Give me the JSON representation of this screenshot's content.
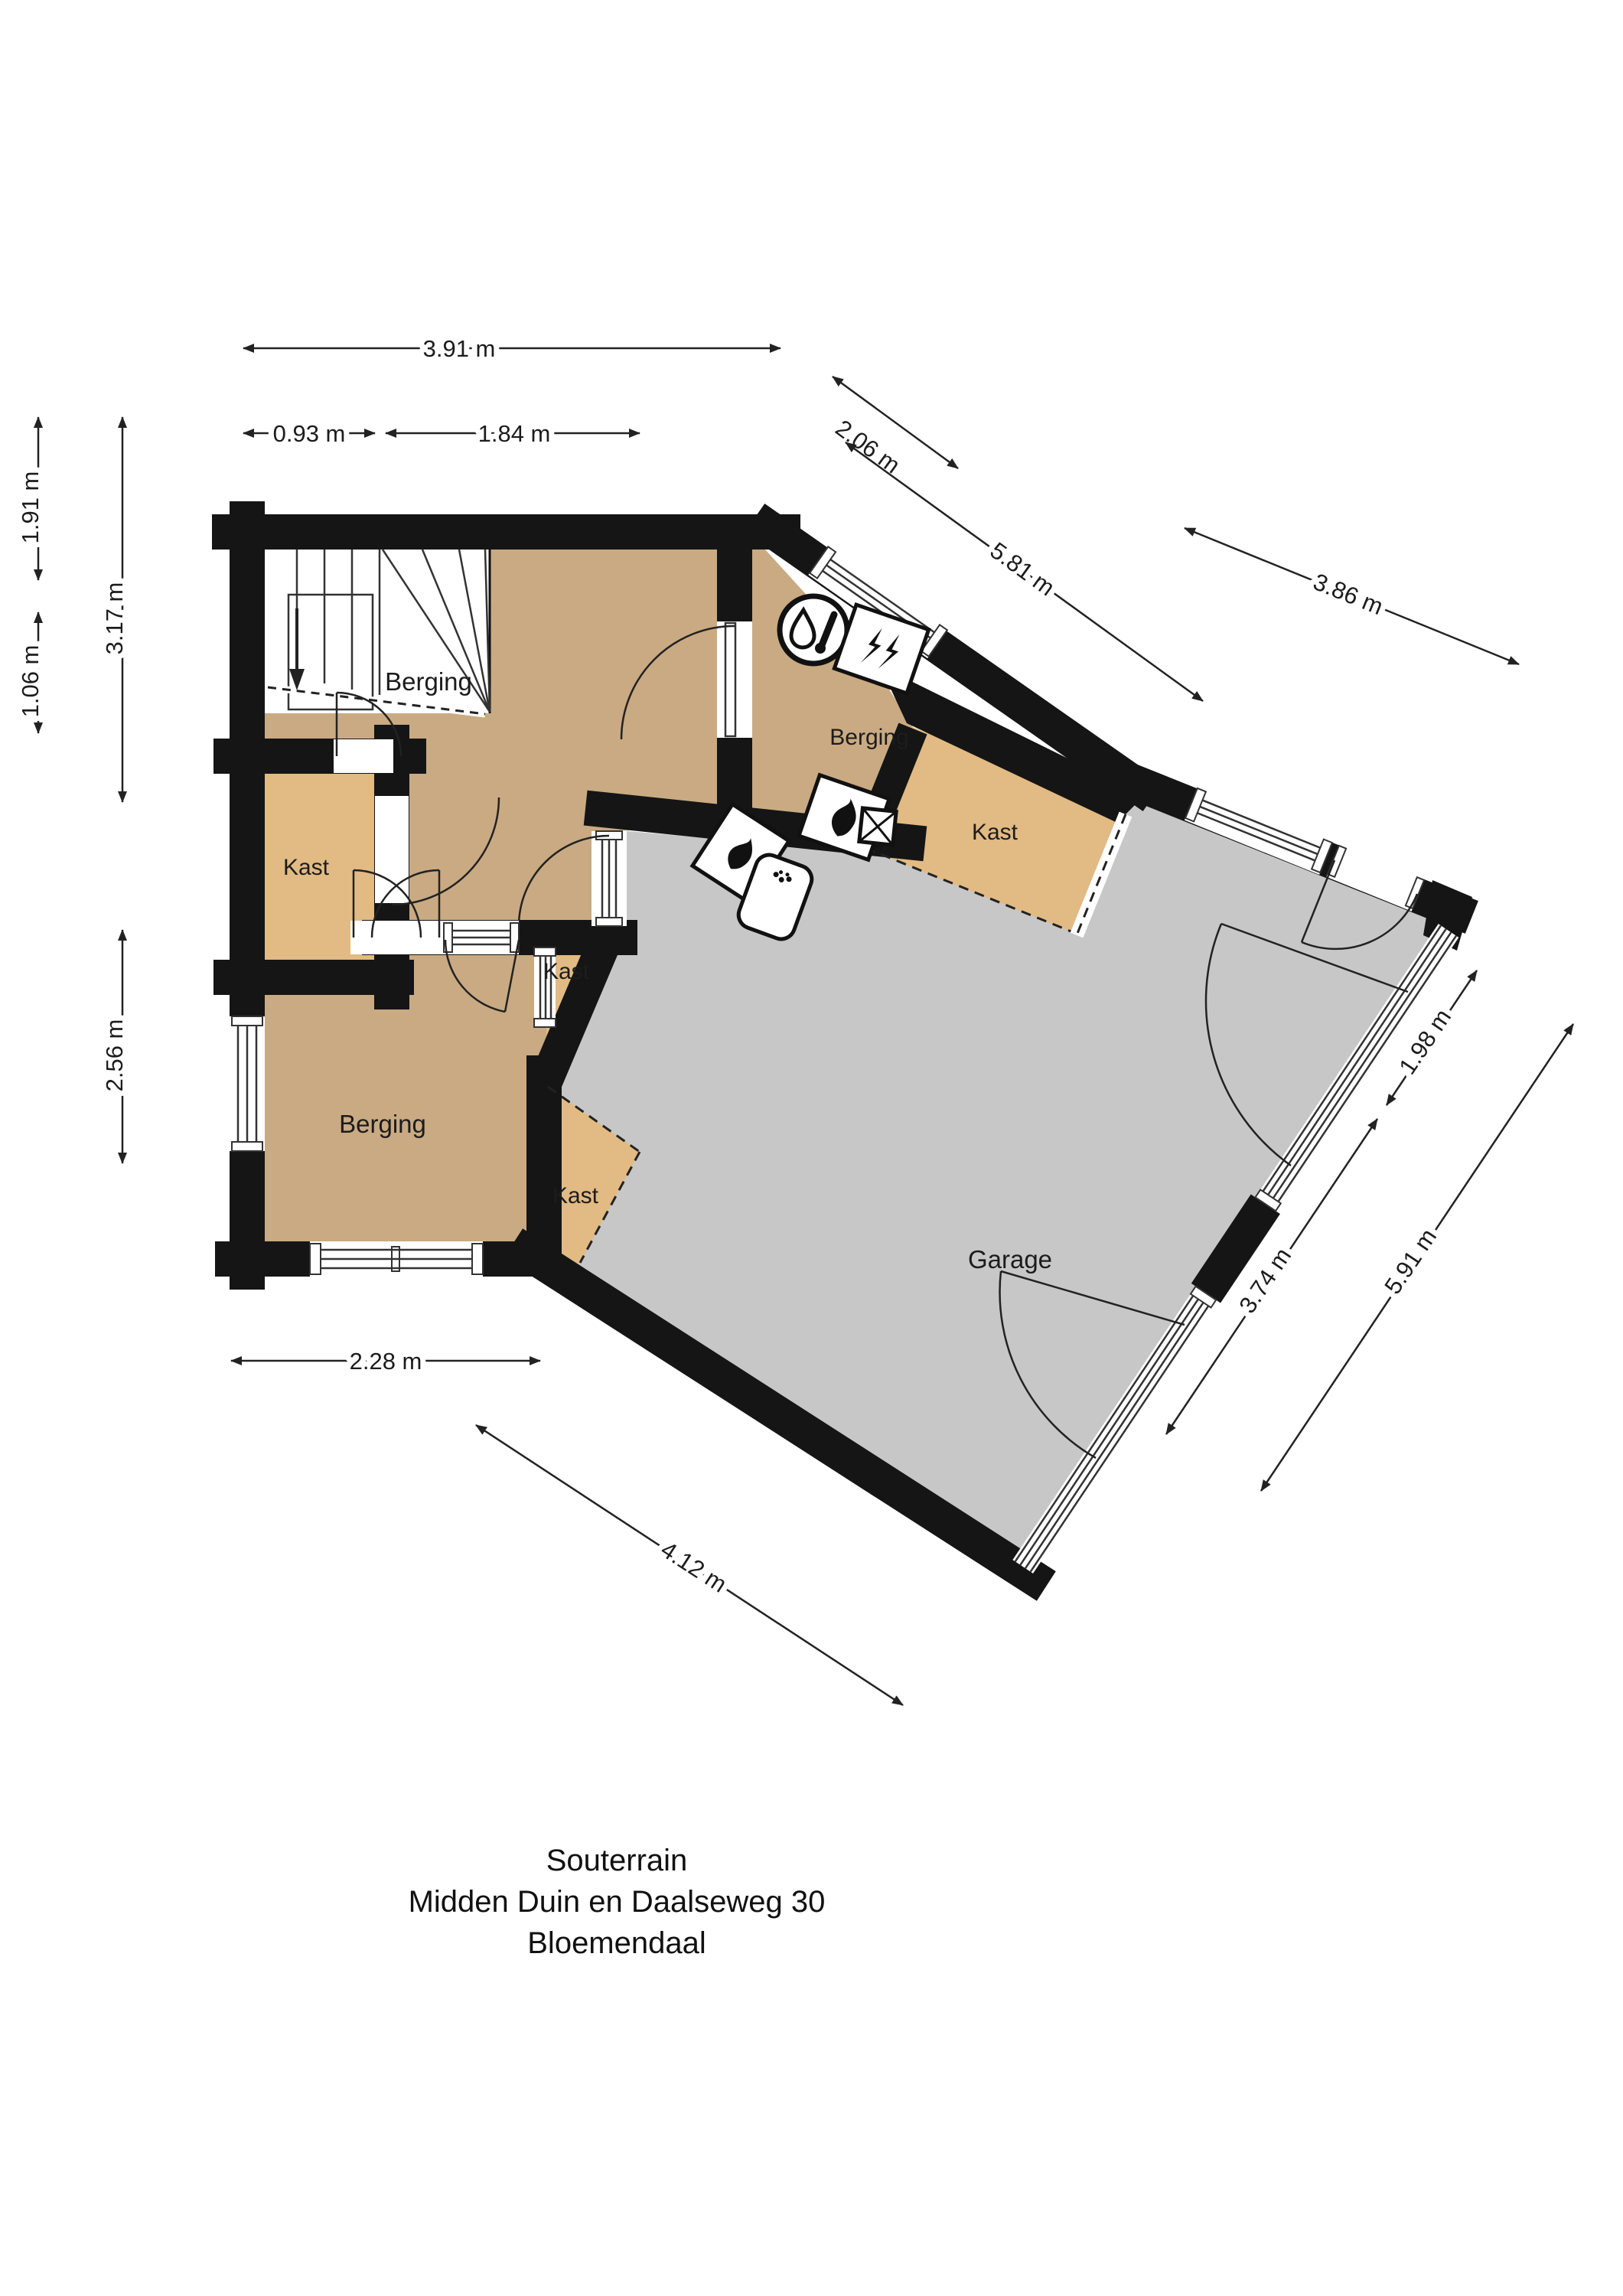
{
  "title": {
    "line1": "Souterrain",
    "line2": "Midden Duin en Daalseweg 30",
    "line3": "Bloemendaal"
  },
  "rooms": {
    "berging1": "Berging",
    "berging2": "Berging",
    "berging3": "Berging",
    "garage": "Garage",
    "kast1": "Kast",
    "kast2": "Kast",
    "kast3": "Kast",
    "kast4": "Kast"
  },
  "dimensions": {
    "top_total": "3.91 m",
    "top_a": "0.93 m",
    "top_b": "1.84 m",
    "ne_short": "2.06 m",
    "ne_mid": "5.81 m",
    "ne_long": "3.86 m",
    "left_a": "1.91 m",
    "left_b": "3.17 m",
    "left_c": "1.06 m",
    "left_d": "2.56 m",
    "bottom_a": "2.28 m",
    "bottom_diag": "4.12 m",
    "right_a": "1.98 m",
    "right_b": "3.74 m",
    "right_c": "5.91 m"
  },
  "icons": {
    "boiler": "boiler-thermometer-icon",
    "vent": "ventilation-unit-icon",
    "heater1": "heater-flame-icon",
    "heater2": "heater-flame-icon",
    "appliance": "appliance-rounded-icon",
    "shaft": "shaft-cross-icon",
    "stairs_arrow": "stairs-down-arrow-icon"
  },
  "colors": {
    "wall": "#151515",
    "floor_storage": "#c9aa82",
    "floor_closet": "#e2ba83",
    "floor_garage": "#c7c7c7",
    "background": "#ffffff",
    "dim_line": "#222222"
  }
}
